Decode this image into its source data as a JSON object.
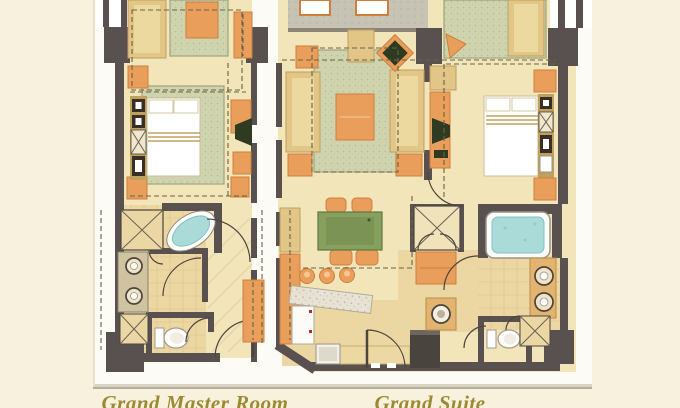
{
  "captions": {
    "left": "Grand Master Room",
    "right": "Grand Suite"
  },
  "units": [
    {
      "caption_ref": "left",
      "features": [
        "sofa",
        "lounge-rug",
        "king-bed",
        "nightstands",
        "tv-console",
        "wardrobe",
        "oval-bathtub",
        "shower",
        "double-vanity-sinks",
        "toilet",
        "entry-door"
      ]
    },
    {
      "caption_ref": "right",
      "features": [
        "terrace",
        "skylights",
        "living-sofas",
        "armchair",
        "coffee-table",
        "tv",
        "dining-table",
        "dining-chairs",
        "granite-bar-counter",
        "bar-stools",
        "kitchen-counter",
        "kitchen-sink",
        "wash-basin",
        "king-bed",
        "bench",
        "walk-in-shower",
        "wardrobe",
        "jacuzzi-tub",
        "double-vanity-sinks",
        "toilet",
        "entry-door"
      ]
    }
  ],
  "palette": {
    "bg": "#f8f1dd",
    "sheet": "#fcfbf5",
    "wall": "#585150",
    "floor": "#f3e5ba",
    "tile": "#ecd7a2",
    "carpet": "#cfd3ae",
    "carpetline": "#9aa47c",
    "tan": "#e2c688",
    "tandark": "#bfa05e",
    "orange": "#e99e5b",
    "orangedark": "#cf7f3d",
    "tablegreen": "#87a05e",
    "tvdark": "#2e3a22",
    "aqua": "#aadbd9",
    "aquadark": "#7fc3c4",
    "granite": "#e7e2d4",
    "terrace": "#c6c3b4",
    "gold": "#9c8a33",
    "dash": "#6a6243"
  }
}
